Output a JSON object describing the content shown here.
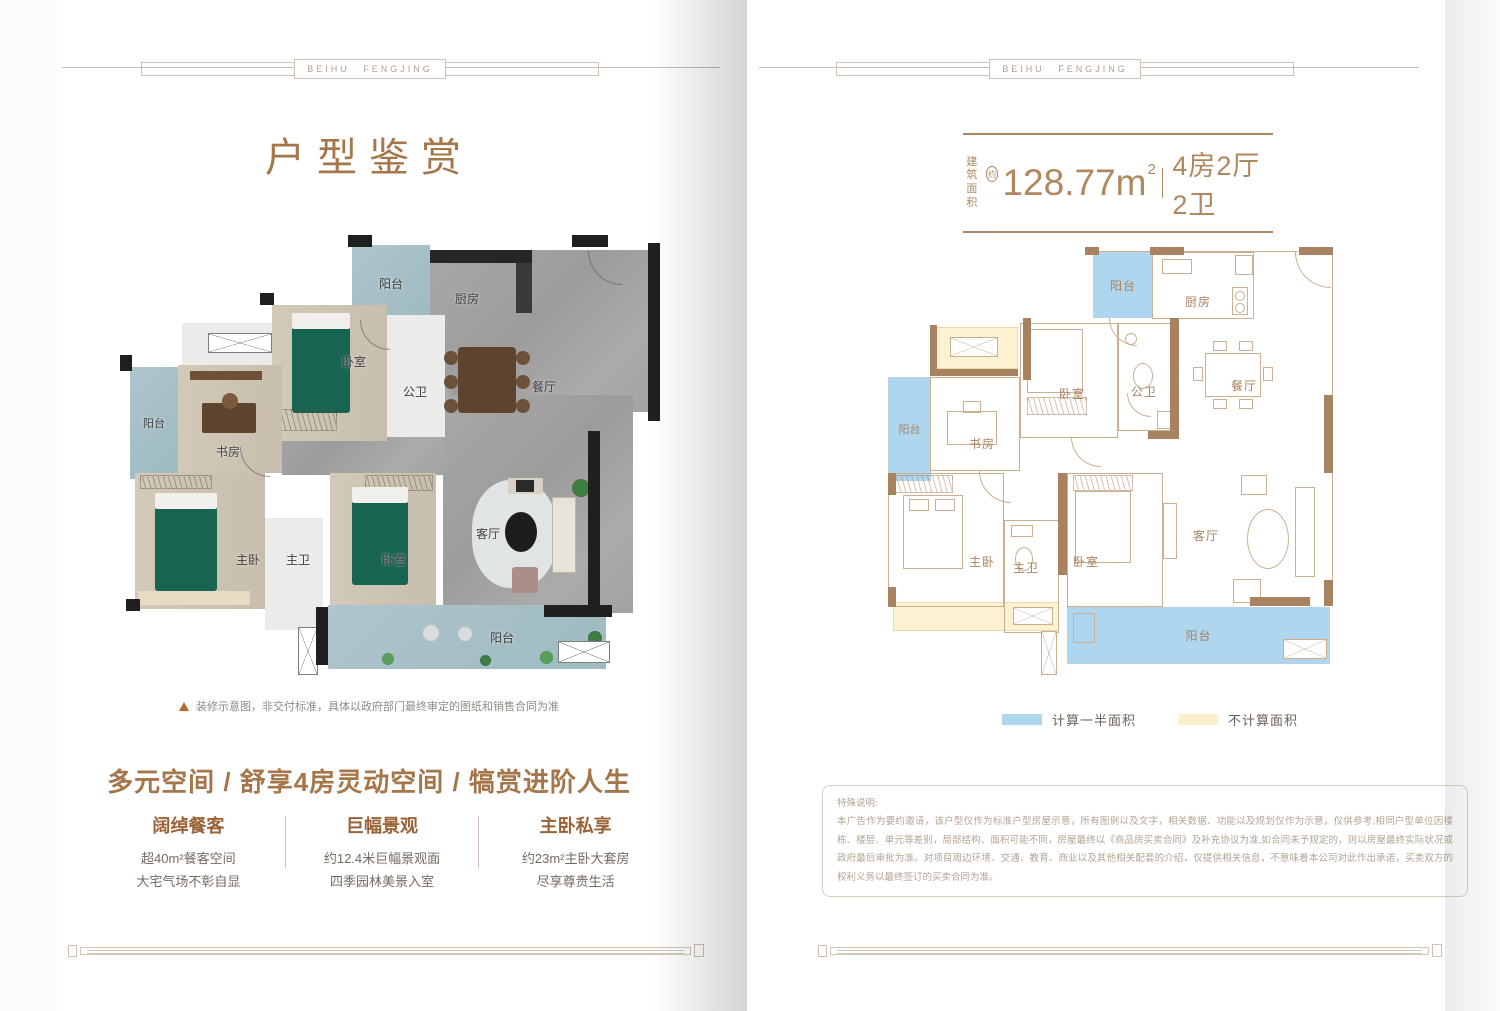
{
  "brand": "BEIHU FENGJING",
  "left_page": {
    "title": "户型鉴赏",
    "disclaimer": "装修示意图，非交付标准，具体以政府部门最终审定的图纸和销售合同为准",
    "headline": "多元空间 / 舒享4房灵动空间 / 犒赏进阶人生",
    "features": [
      {
        "title": "阔绰餐客",
        "line1": "超40m²餐客空间",
        "line2": "大宅气场不彰自显"
      },
      {
        "title": "巨幅景观",
        "line1": "约12.4米巨幅景观面",
        "line2": "四季园林美景入室"
      },
      {
        "title": "主卧私享",
        "line1": "约23m²主卧大套房",
        "line2": "尽享尊贵生活"
      }
    ]
  },
  "right_page": {
    "spec": {
      "area_label_top": "建筑",
      "area_label_bottom": "面积",
      "approx": "约",
      "area_value": "128.77m",
      "area_exponent": "2",
      "layout": "4房2厅2卫"
    },
    "legend": {
      "half_area": "计算一半面积",
      "no_area": "不计算面积"
    },
    "notes": {
      "title": "特殊说明:",
      "body": "本广告作为要约邀请，该户型仅作为标准户型房屋示意，所有图例以及文字，相关数据、功能以及规划仅作为示意，仅供参考;相同户型单位因楼栋、楼层、单元等差别，局部结构、面积可能不同，房屋最终以《商品房买卖合同》及补充协议为准,如合同未予规定的，则以房屋最终实际状况或政府最后审批为准。对项目周边环境、交通、教育、商业以及其他相关配套的介绍，仅提供相关信息，不意味着本公司对此作出承诺，买卖双方的权利义务以最终签订的买卖合同为准。"
    }
  },
  "room_labels": {
    "balcony": "阳台",
    "kitchen": "厨房",
    "bedroom": "卧室",
    "guest_bath": "公卫",
    "dining": "餐厅",
    "study": "书房",
    "master": "主卧",
    "master_bath": "主卫",
    "living": "客厅"
  },
  "colors": {
    "accent": "#a5764a",
    "wall_brown": "#a9825f",
    "half_area_fill": "#aed7ef",
    "no_area_fill": "#fbefcd"
  }
}
